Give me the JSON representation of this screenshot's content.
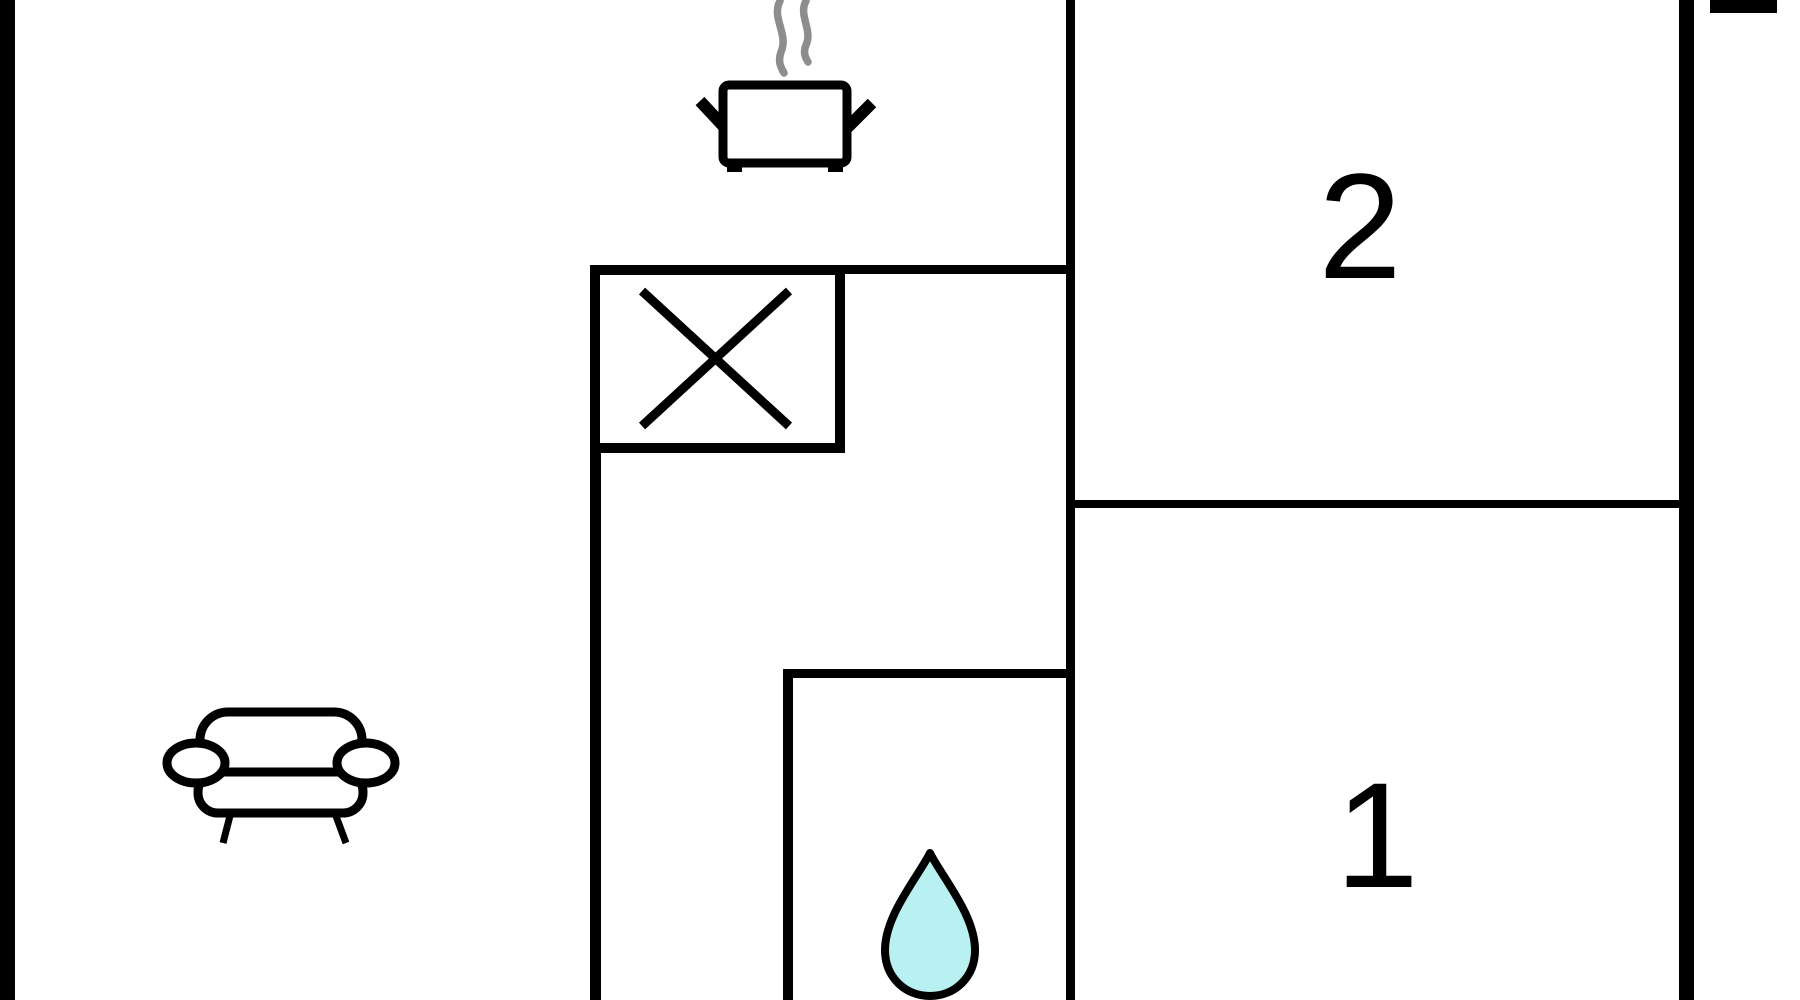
{
  "plan": {
    "room_labels": {
      "room_2": "2",
      "room_1": "1"
    },
    "colors": {
      "wall": "#000000",
      "background": "#ffffff",
      "water_drop_fill": "#b9f1f2",
      "steam_gray": "#8d8d8d"
    },
    "icons": [
      "steam-icon",
      "cooking-pot-icon",
      "stove-hob-icon",
      "sofa-icon",
      "water-drop-icon",
      "window-marker-icon"
    ]
  }
}
